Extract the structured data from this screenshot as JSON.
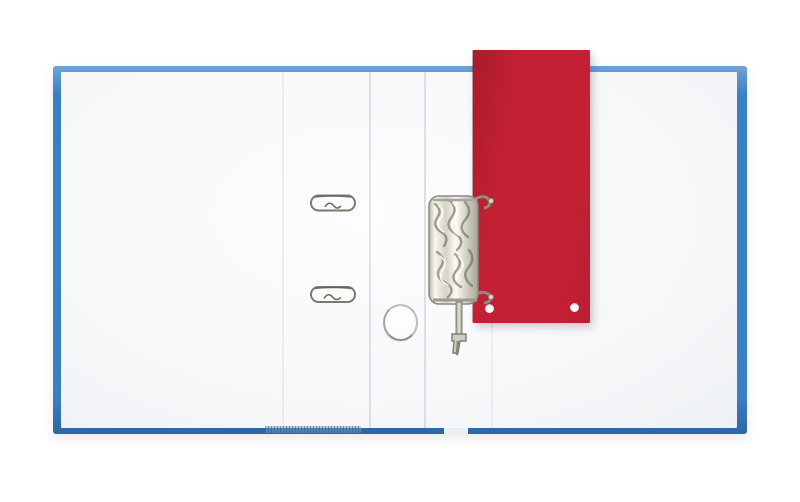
{
  "scene": {
    "description": "Top view photograph of an open blue lever-arch ring binder with white inner pages; a red cardboard divider sheet is punched onto the chrome ring mechanism; two flat metal clips and a round metal ring lie on the left page",
    "objects": {
      "binder_cover": "blue lever-arch binder cover",
      "binder_pages": "white inner pages",
      "red_divider": "red punched divider sheet",
      "mechanism": "chrome lever-arch ring mechanism",
      "clip_top": "upper flat metal clip slot",
      "clip_bottom": "lower flat metal clip slot",
      "finger_ring": "round metal grip ring",
      "punch_holes": "white punch holes in red divider"
    }
  },
  "colors": {
    "background": "#ffffff",
    "binder-blue": "#3b7fc3",
    "binder-blue-dark": "#2d66a4",
    "binder-blue-light": "#6ea3d6",
    "page-white": "#f7f8fa",
    "red-divider": "#c32133",
    "red-divider-dark": "#a91b2c",
    "metal-light": "#f8f6ee",
    "metal-mid": "#c9c6ba",
    "metal-dark": "#5f5b4e",
    "wire-gray": "#8d8b80"
  }
}
